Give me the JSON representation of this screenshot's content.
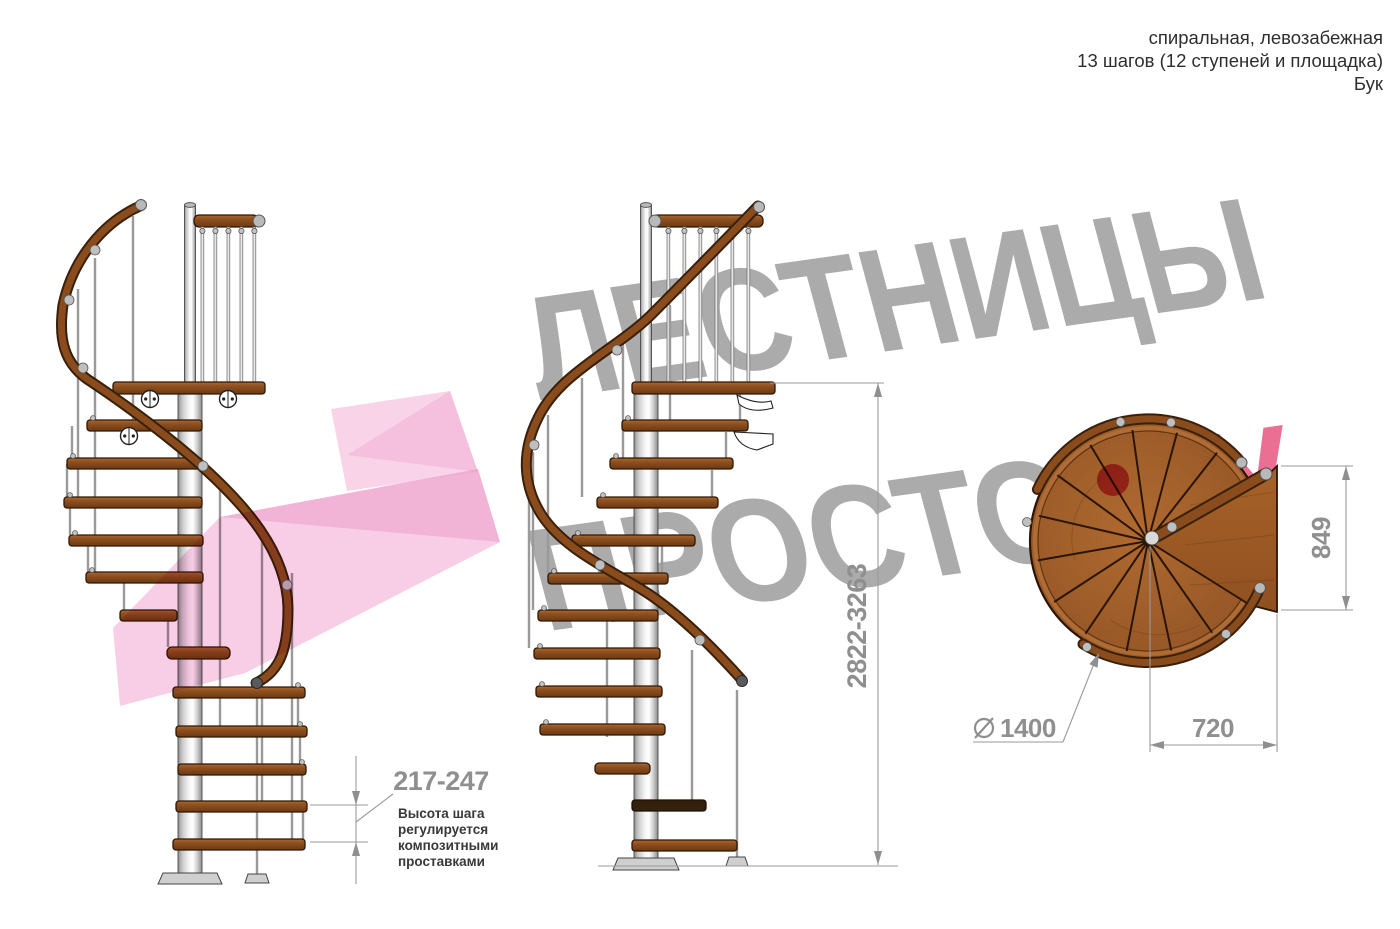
{
  "header": {
    "title_line1": "спиральная, левозабежная",
    "title_line2": "13 шагов (12 ступеней и площадка)",
    "title_line3": "Бук"
  },
  "watermark": {
    "line1": "ЛЕСТНИЦЫ",
    "line2": "ПРОСТО",
    "tld": "РУ",
    "text_color": "#a4a4a4",
    "accent_color": "#e9688e",
    "dot_color": "#d4285c",
    "arrow_color": "#f4aed6"
  },
  "dimensions": {
    "total_height": "2822-3263",
    "step_height": "217-247",
    "platform_depth": "849",
    "platform_width": "720",
    "diameter_value": "1400"
  },
  "annotation": {
    "line1": "Высота шага",
    "line2": "регулируется",
    "line3": "композитными",
    "line4": "проставками"
  },
  "colors": {
    "wood": "#8a4c1d",
    "wood_outline": "#2d1706",
    "metal": "#d9d9d9",
    "dimension_gray": "#8f8f8f",
    "header_text": "#2e2e2e"
  }
}
